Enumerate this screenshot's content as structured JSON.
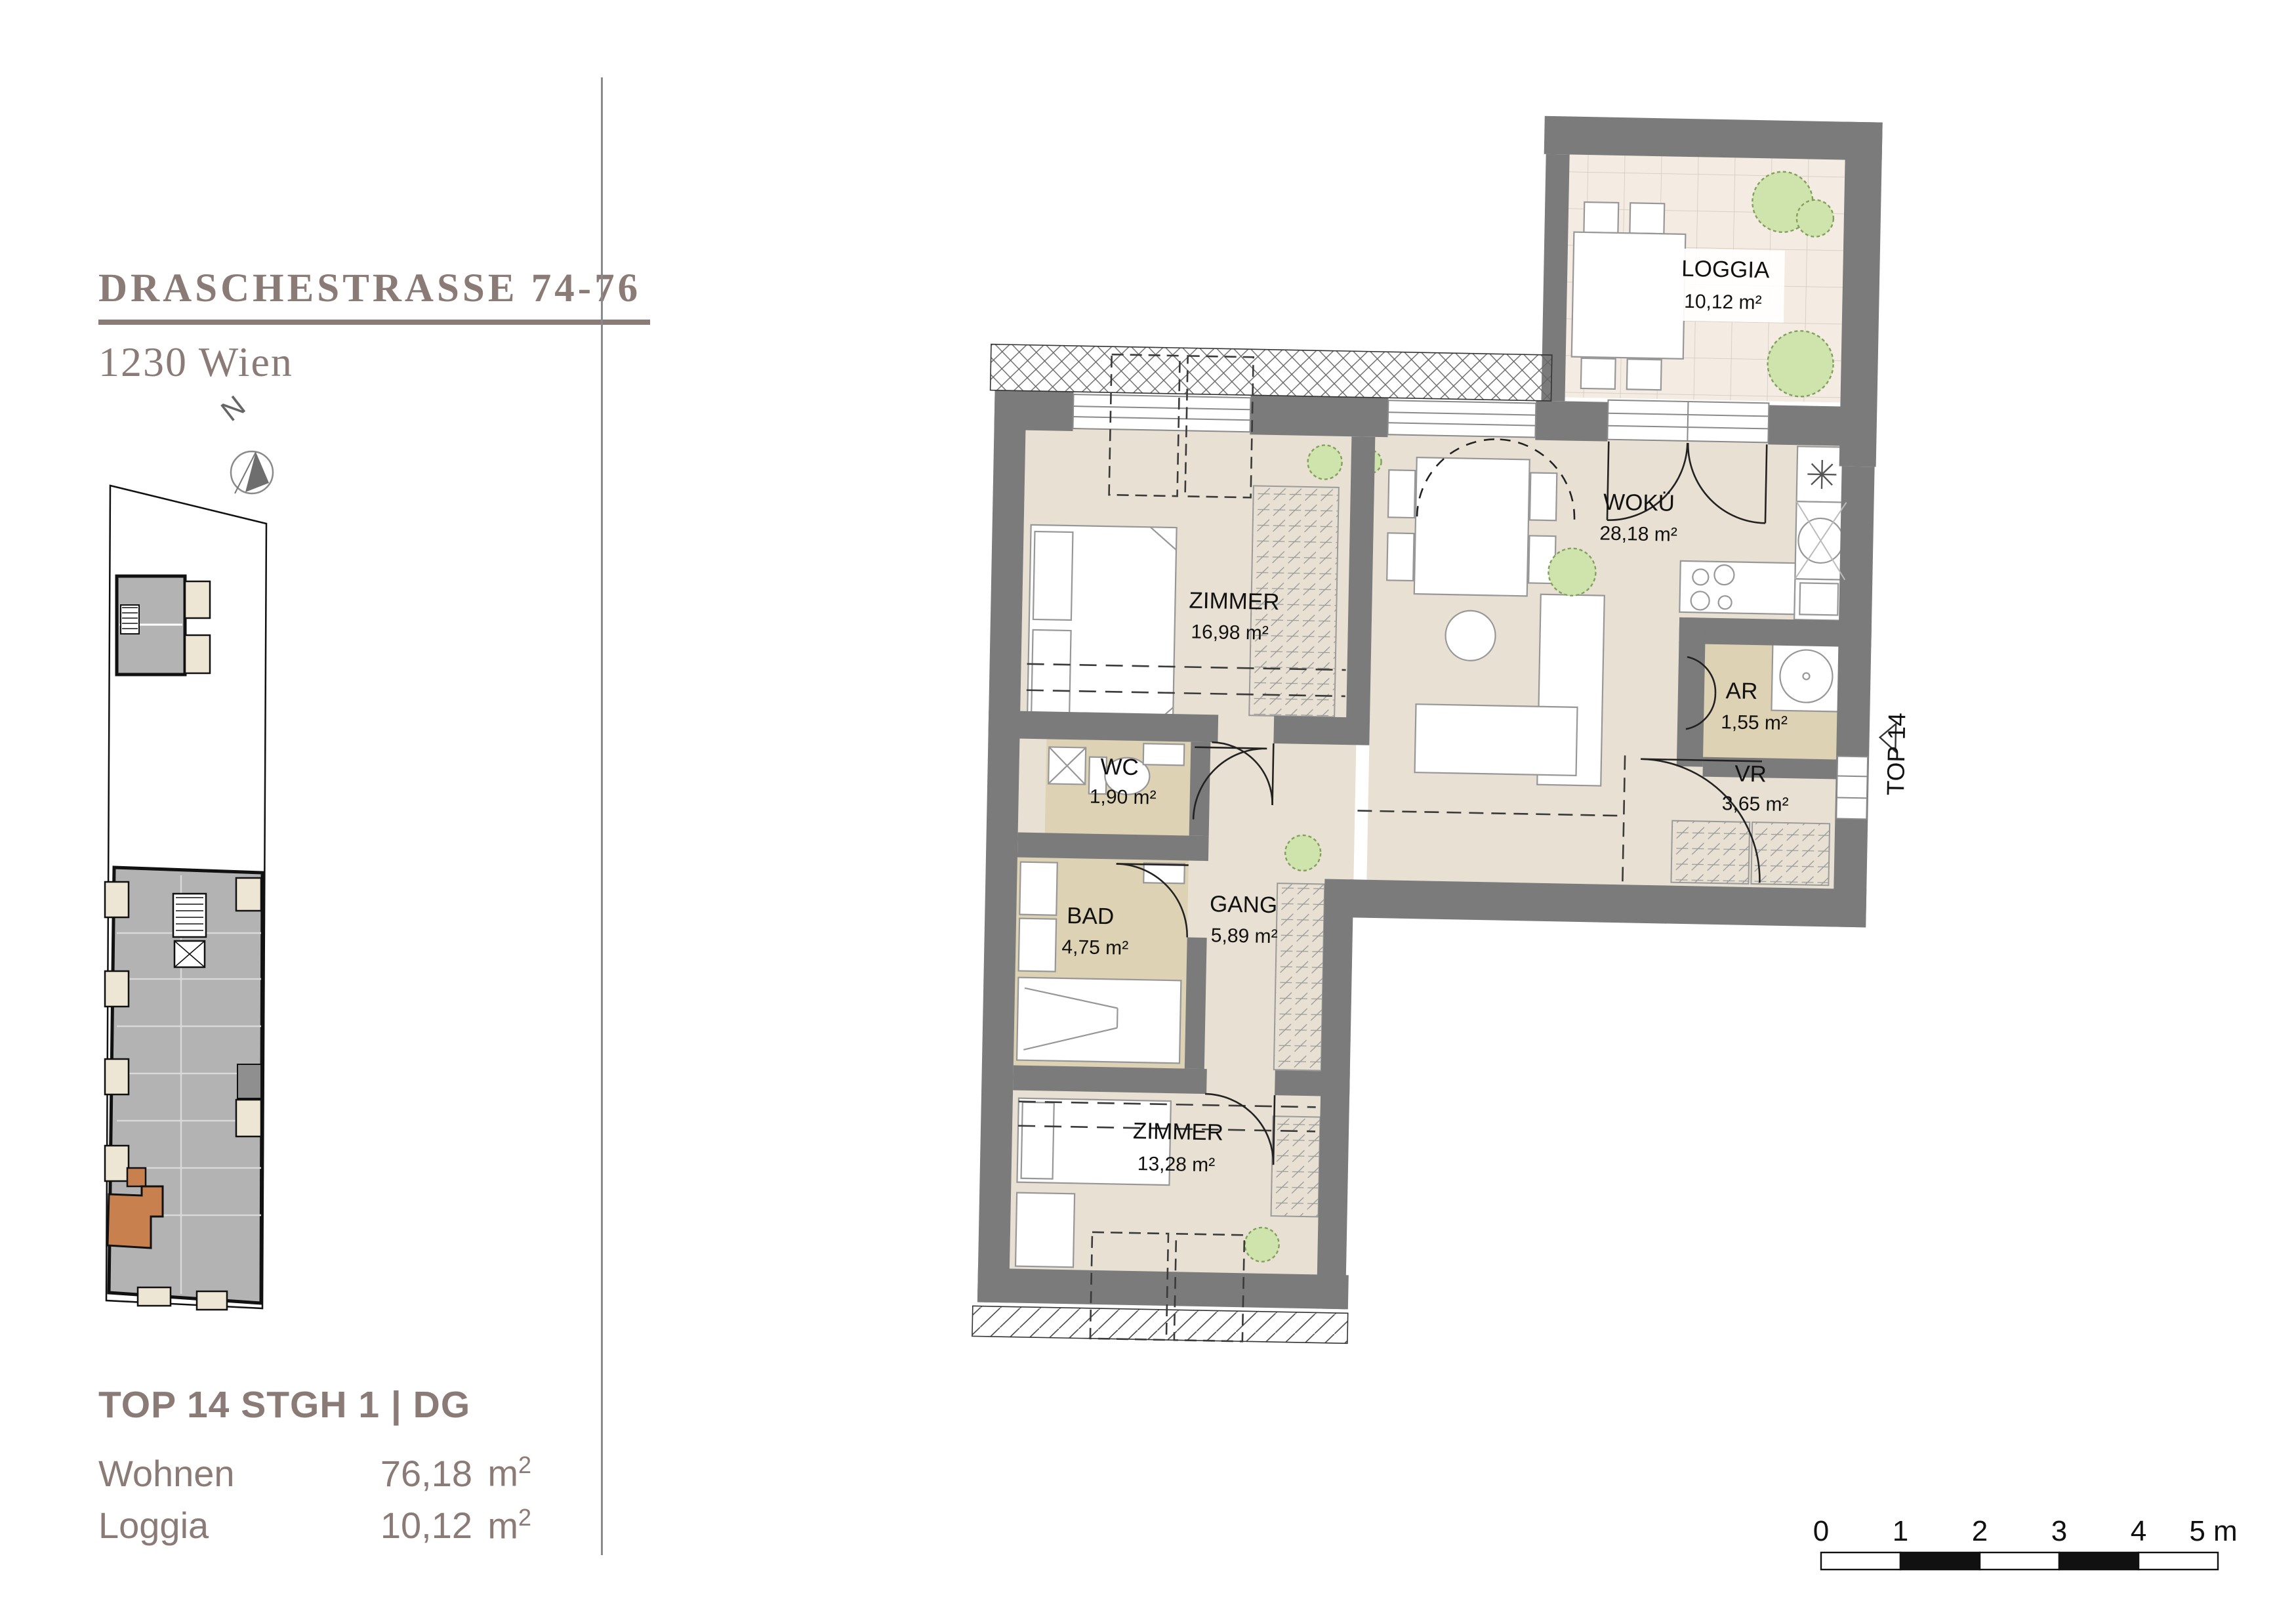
{
  "project": {
    "title": "DRASCHESTRASSE 74-76",
    "city": "1230 Wien"
  },
  "compass": {
    "label": "N"
  },
  "unit": {
    "heading": "TOP 14 STGH 1 | DG",
    "rows": [
      {
        "label": "Wohnen",
        "value": "76,18",
        "unit": "m",
        "unit_sup": "2"
      },
      {
        "label": "Loggia",
        "value": "10,12",
        "unit": "m",
        "unit_sup": "2"
      }
    ]
  },
  "plan": {
    "entrance_label": "TOP 14",
    "rooms": [
      {
        "name": "LOGGIA",
        "area": "10,12 m²"
      },
      {
        "name": "WOKÜ",
        "area": "28,18 m²"
      },
      {
        "name": "ZIMMER",
        "area": "16,98 m²"
      },
      {
        "name": "WC",
        "area": "1,90 m²"
      },
      {
        "name": "BAD",
        "area": "4,75 m²"
      },
      {
        "name": "GANG",
        "area": "5,89 m²"
      },
      {
        "name": "ZIMMER",
        "area": "13,28 m²"
      },
      {
        "name": "AR",
        "area": "1,55 m²"
      },
      {
        "name": "VR",
        "area": "3,65 m²"
      }
    ]
  },
  "scalebar": {
    "ticks": [
      "0",
      "1",
      "2",
      "3",
      "4",
      "5 m"
    ]
  },
  "colors": {
    "accent_orange": "#c8804f",
    "wall_gray": "#7b7b7b",
    "floor": "#e8e1d3",
    "floor_bath": "#ddd2b4",
    "floor_loggia": "#f4ece2",
    "text_brown": "#8b7b77"
  }
}
